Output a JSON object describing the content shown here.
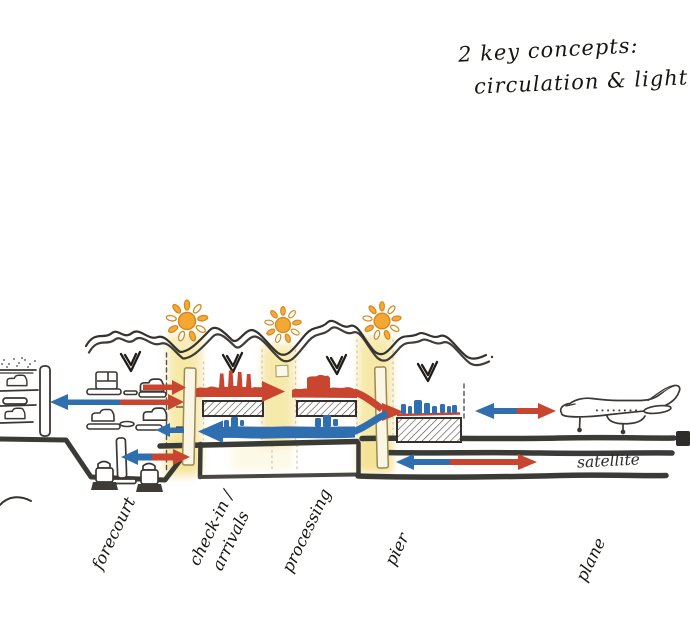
{
  "title": {
    "line1": "2 key concepts:",
    "line2": "circulation & light"
  },
  "zone_labels": {
    "forecourt": "forecourt",
    "checkin": "check-in /",
    "arrivals": "arrivals",
    "processing": "processing",
    "pier": "pier",
    "plane": "plane",
    "satellite": "satellite"
  },
  "colors": {
    "departure_flow_red": "#c9452f",
    "arrival_flow_blue": "#2f6fb0",
    "daylight_yellow": "#f2dc80",
    "sun_orange": "#f5a733",
    "ink": "#35322e"
  }
}
